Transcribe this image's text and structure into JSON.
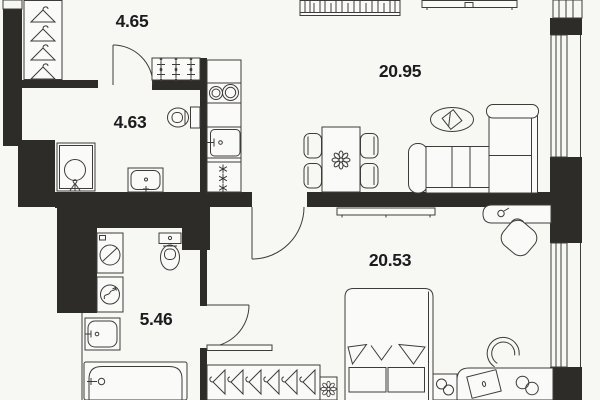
{
  "plan": {
    "title": "apartment-floor-plan",
    "colors": {
      "background": "#f7f7f4",
      "wall": "#2e2c29",
      "line": "#3e3c39",
      "label": "#1c1c1e",
      "fixture_fill": "#fafaf8"
    },
    "rooms": [
      {
        "name": "hallway",
        "area_label": "4.65",
        "label_x": 132,
        "label_y": 27,
        "fixtures": [
          "wardrobe-hangers",
          "shoe-cabinet"
        ]
      },
      {
        "name": "bathroom-small",
        "area_label": "4.63",
        "label_x": 130,
        "label_y": 128,
        "fixtures": [
          "shower-cabin",
          "toilet",
          "washbasin"
        ]
      },
      {
        "name": "living-room-kitchen",
        "area_label": "20.95",
        "label_x": 400,
        "label_y": 77,
        "fixtures": [
          "bookshelf",
          "tv-console",
          "kitchen-hob",
          "kitchen-sink",
          "dishwasher",
          "dining-table",
          "chairs",
          "rug",
          "corner-sofa"
        ]
      },
      {
        "name": "bedroom",
        "area_label": "20.53",
        "label_x": 390,
        "label_y": 266,
        "fixtures": [
          "dresser",
          "desk",
          "office-chair",
          "double-bed",
          "nightstand",
          "work-desk",
          "laptop",
          "headphones",
          "wardrobe-hangers",
          "plant"
        ]
      },
      {
        "name": "bathroom-large",
        "area_label": "5.46",
        "label_x": 156,
        "label_y": 325,
        "fixtures": [
          "washing-machine",
          "towel-dryer",
          "toilet",
          "washbasin",
          "bathtub"
        ]
      }
    ],
    "doors": 3,
    "windows": 2
  }
}
